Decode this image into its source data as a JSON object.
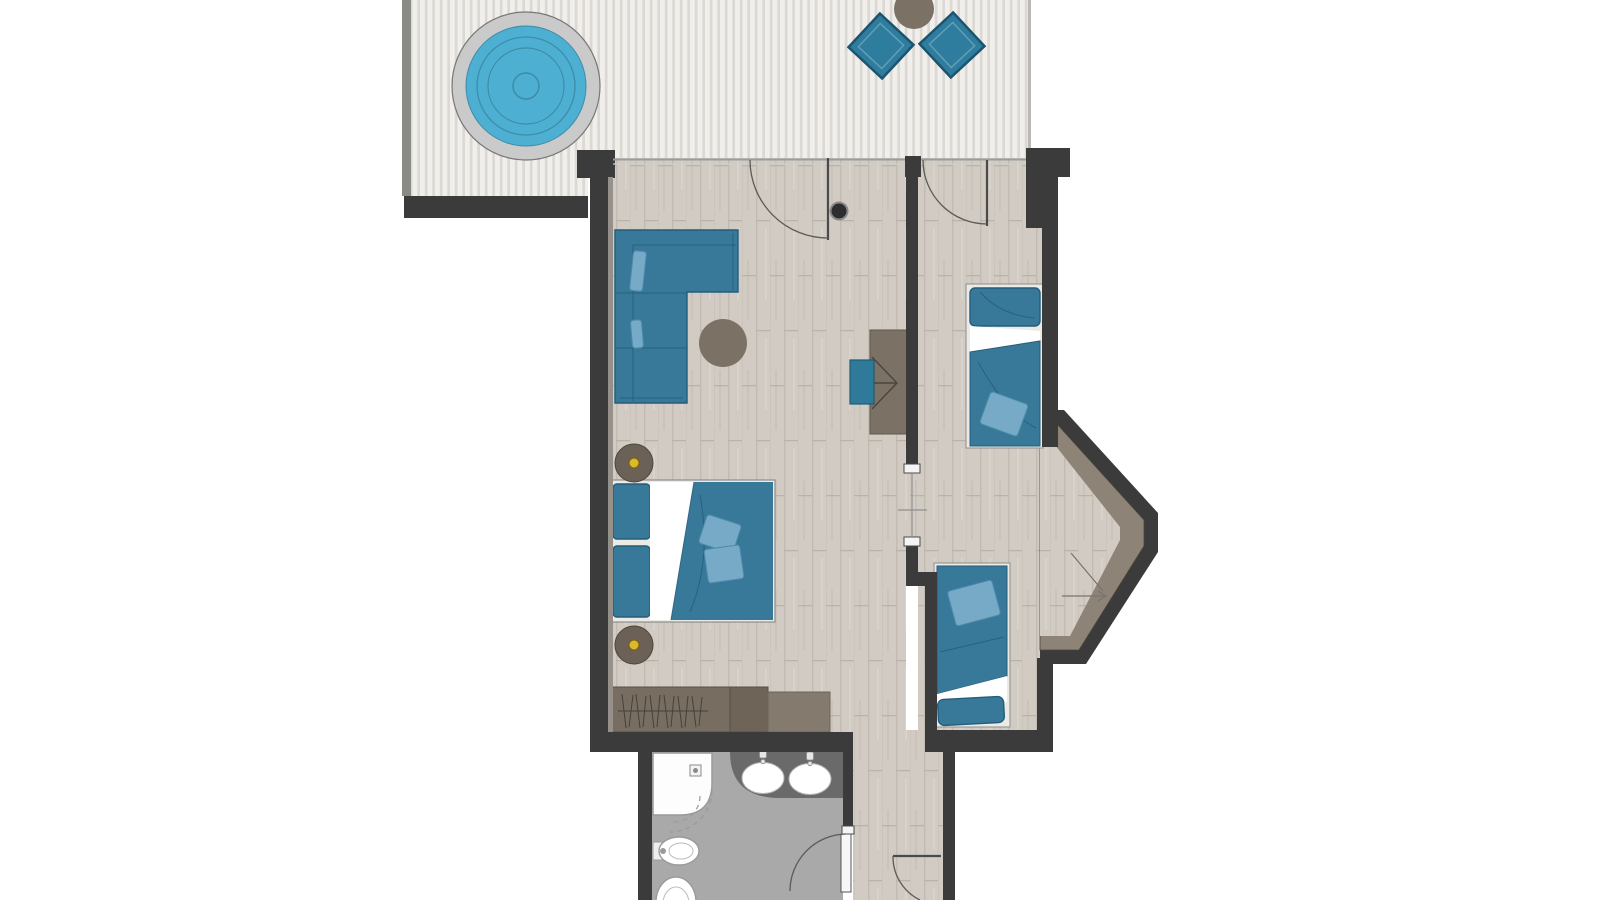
{
  "meta": {
    "description": "Architectural floor plan of a hotel suite, top-down view, no text labels visible",
    "orientation": "plan cropped at top and bottom edges"
  },
  "colors": {
    "wall": "#3b3b3b",
    "wall_light": "#8b8b86",
    "deck_light": "#f1efeb",
    "deck_stripe": "#dcd8d3",
    "wood_base": "#d1cbc3",
    "wood_grain": "#c2bbb1",
    "wood_joint": "#bab3a9",
    "bath_floor": "#a9a9a9",
    "teal": "#38799a",
    "teal_dark": "#235d7b",
    "cushion": "#76aac7",
    "tub_blue": "#4db0d2",
    "tub_rim": "#cacaca",
    "brown": "#7b7165",
    "brown_dark": "#6b6156",
    "wardrobe_a": "#776e61",
    "wardrobe_b": "#6e6558",
    "wardrobe_c": "#847b6e",
    "sill": "#8d8477",
    "counter": "#6a6a6a",
    "fixture": "#fdfdfd",
    "fixture_stroke": "#9a9a9a",
    "accent_yellow": "#ddb82a",
    "frame_white": "#eceae5",
    "dot_dark": "#2e2e2e"
  },
  "rooms": [
    {
      "id": "terrace",
      "label": "Terrace with hot tub and lounge chairs"
    },
    {
      "id": "living-bedroom",
      "label": "Living room with double bed, corner sofa, desk and wardrobe"
    },
    {
      "id": "second-bedroom",
      "label": "Second room with two single beds"
    },
    {
      "id": "bay-window",
      "label": "Bay window alcove"
    },
    {
      "id": "bathroom",
      "label": "Bathroom with shower, double washbasin, bidet and WC"
    },
    {
      "id": "entrance",
      "label": "Entrance corridor"
    }
  ],
  "furniture": [
    "hot-tub",
    "lounge-chair",
    "lounge-chair",
    "terrace-side-table",
    "corner-sofa",
    "round-pouf",
    "desk",
    "desk-chair",
    "double-bed",
    "nightstand",
    "nightstand",
    "wardrobe",
    "single-bed",
    "single-bed",
    "shower",
    "washbasin",
    "washbasin",
    "vanity-counter",
    "bidet",
    "toilet"
  ],
  "doors": [
    "terrace-to-living-door",
    "terrace-to-second-room-door",
    "inner-passage",
    "bathroom-door",
    "entrance-door"
  ]
}
